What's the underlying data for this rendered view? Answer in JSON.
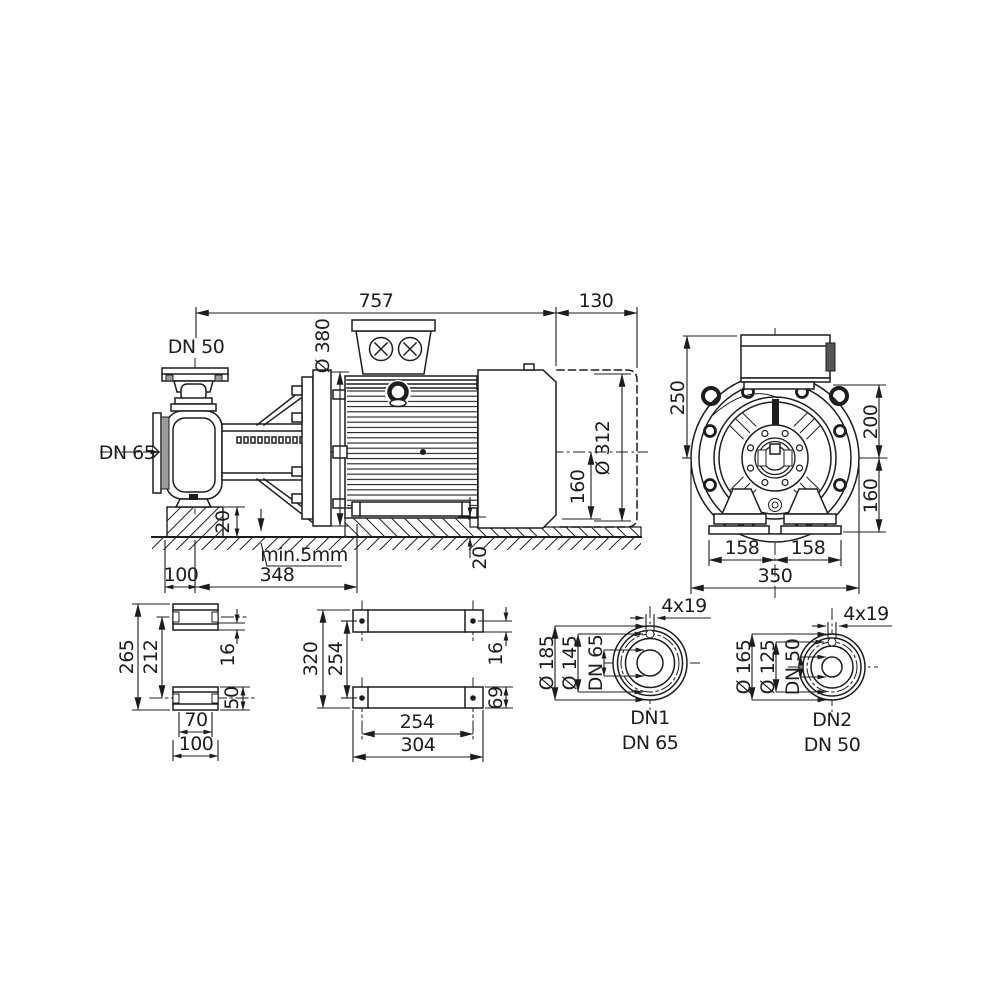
{
  "side_view": {
    "total_length": "757",
    "fan_clearance": "130",
    "discharge_flange": "DN 50",
    "motor_flange_dia": "Ø 380",
    "suction_flange": "DN 65",
    "fan_cowl_dia": "Ø 312",
    "shaft_height": "160",
    "pump_pad_height": "20",
    "min_gap": "min.5mm",
    "pad_offset": "100",
    "foot_distance": "348",
    "motor_pad_height": "20"
  },
  "front_view": {
    "height_above_center": "250",
    "terminal_box_height": "200",
    "shaft_height": "160",
    "foot_spacing_left": "158",
    "foot_spacing_right": "158",
    "overall_width": "350"
  },
  "pump_foot_view": {
    "overall_height": "265",
    "hole_spacing": "212",
    "plate_thickness": "16",
    "foot_height": "50",
    "slot_spacing": "70",
    "foot_width": "100"
  },
  "motor_foot_view": {
    "overall_depth": "320",
    "hole_spacing_depth": "254",
    "plate_thickness": "16",
    "foot_height": "69",
    "hole_spacing_width": "254",
    "overall_width": "304"
  },
  "flange_dn1": {
    "outer_dia": "Ø 185",
    "bolt_circle_dia": "Ø 145",
    "nominal_dia": "DN 65",
    "bolt_holes": "4x19",
    "port_label": "DN1",
    "port_size": "DN 65"
  },
  "flange_dn2": {
    "outer_dia": "Ø 165",
    "bolt_circle_dia": "Ø 125",
    "nominal_dia": "DN 50",
    "bolt_holes": "4x19",
    "port_label": "DN2",
    "port_size": "DN 50"
  }
}
